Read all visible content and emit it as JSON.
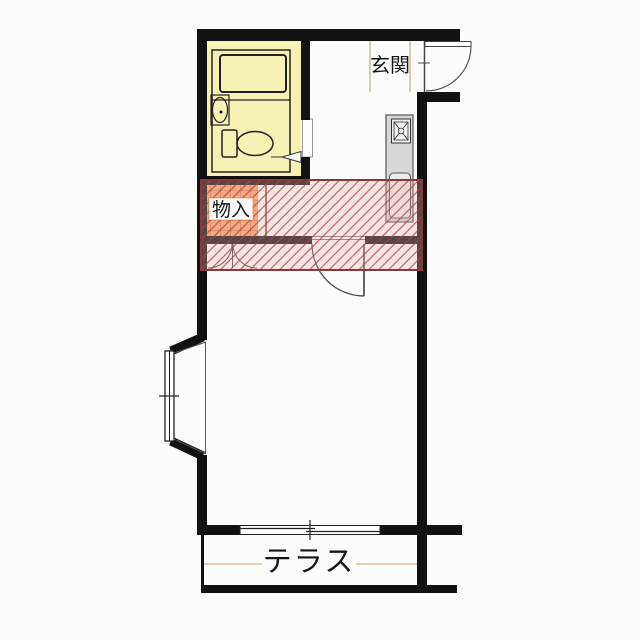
{
  "floorplan": {
    "labels": {
      "entrance": "玄関",
      "storage": "物入",
      "terrace": "テラス"
    },
    "colors": {
      "background": "#FCFCFC",
      "wall": "#121212",
      "bathroom_fill": "#F6F2B4",
      "fixture_stroke": "#222222",
      "kitchen_fill": "#D7D7D7",
      "kitchen_sink_fill": "#ECECEC",
      "storage_fill": "#F2A76B",
      "storage_grid": "#C4562A",
      "overlay_tint": "rgba(242,178,178,0.32)",
      "overlay_hatch": "rgba(165,70,70,0.8)",
      "overlay_border": "#8B3A3A",
      "terrace_line": "#D9BF97",
      "genkan_line": "#C9A87F"
    }
  }
}
